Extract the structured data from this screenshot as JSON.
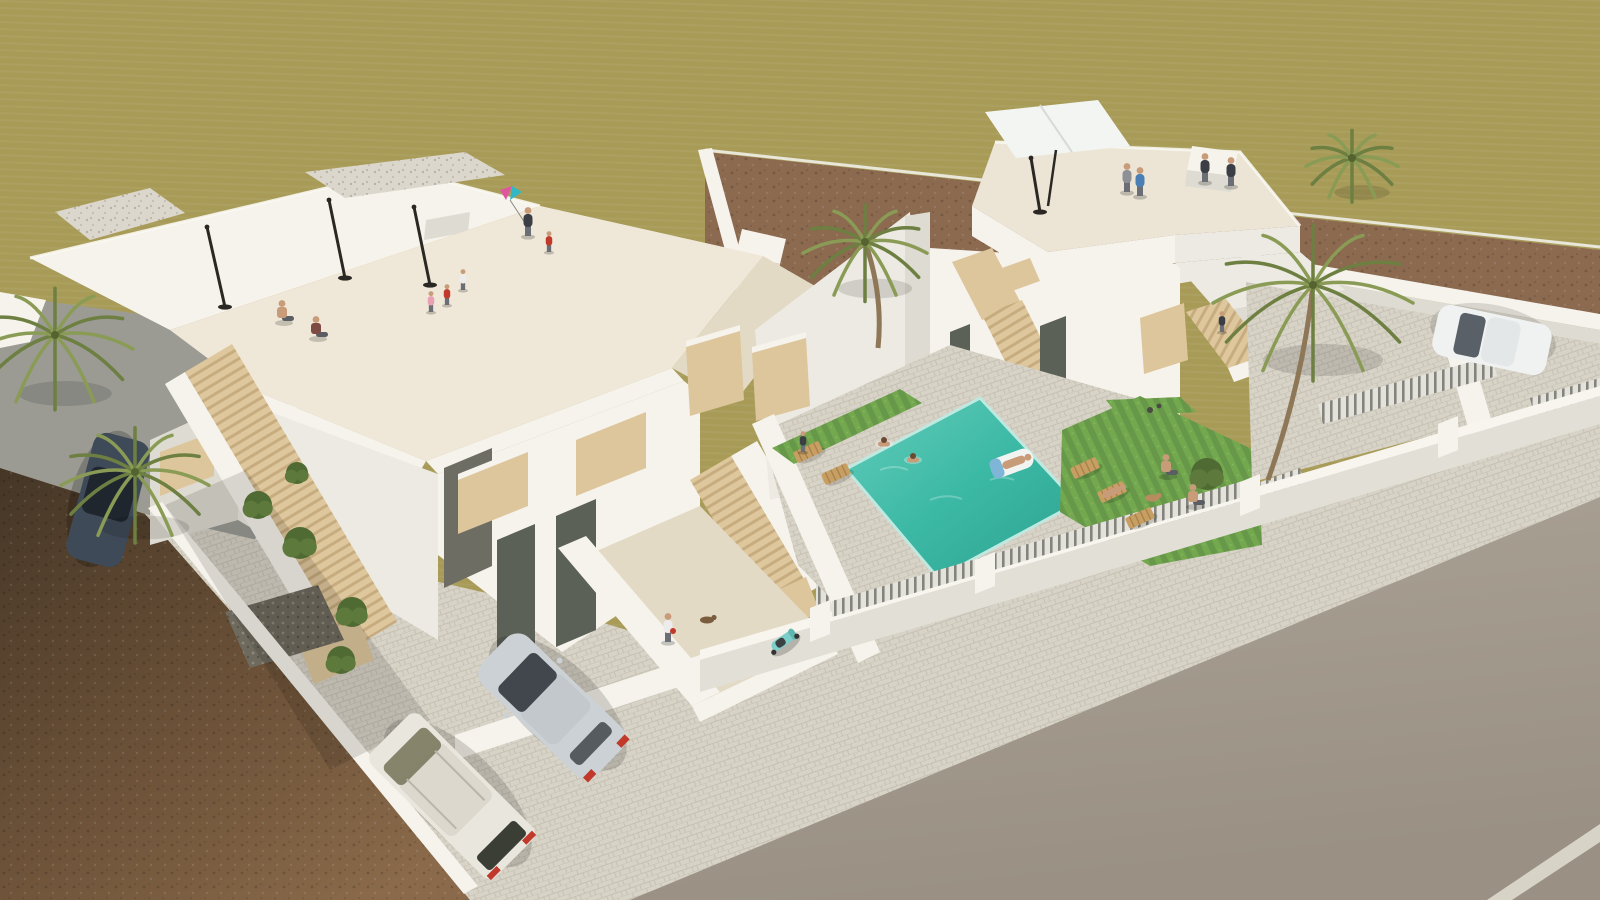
{
  "image": {
    "kind": "architectural-3d-render",
    "description": "Aerial 3D visualization of two modern white multi-storey villas with rooftop terraces, exterior beige staircases, a turquoise swimming pool with swimmers, lawns with sun loungers, palm trees, parked cars, perimeter walls with slatted fences, a cobbled sidewalk and a wide asphalt street; olive-khaki fields and brown dirt plots surround the site.",
    "visible_text": []
  },
  "palette": {
    "olive": "#a89b57",
    "olivelight": "#b7ab6c",
    "dirt": "#8b6a50",
    "dirtdark": "#6f5340",
    "soil": "#7d6146",
    "soildark": "#3f3022",
    "street": "#9b9b94",
    "road": "#a79f92",
    "roaddark": "#988f82",
    "sidewalk": "#d8d3c7",
    "cobbleline": "#c4bfb2",
    "wall": "#f6f3ec",
    "wallmid": "#eceae2",
    "wallshade": "#dedbd2",
    "walldark": "#c7c4ba",
    "cream": "#efe8d8",
    "creamshade": "#e3dac6",
    "wood": "#ddc69c",
    "wooddark": "#c2a87a",
    "glass": "#5c6158",
    "glasslight": "#7c8177",
    "pool": "#3cb9a5",
    "pooldeep": "#2da391",
    "poollight": "#63cdbb",
    "grass": "#73a84f",
    "grassdark": "#628f41",
    "palm": "#6d7f41",
    "palmlight": "#8a9b55",
    "trunk": "#8d7757",
    "carsilver": "#ccd1d5",
    "carglass": "#42474e",
    "van": "#e9e6dd",
    "cardark": "#3f4a58",
    "carwhite": "#f0f2f2",
    "scooter": "#7ccfc9",
    "red": "#c0392b",
    "skin": "#c89b79",
    "black": "#2b2824",
    "white": "#faf8f2"
  },
  "clothing_colors": {
    "skin": "#c89b79",
    "red": "#c0392b",
    "white": "#ececec",
    "blue": "#4a7fb5",
    "gray": "#8d9197",
    "dark": "#3b3f45",
    "maroon": "#7e4a44",
    "pink": "#e8a0b4"
  },
  "scene": {
    "people": [
      {
        "name": "sitting-shirtless-man",
        "x": 282,
        "y": 322,
        "pose": "sit",
        "shirt": "skin"
      },
      {
        "name": "sitting-woman",
        "x": 316,
        "y": 338,
        "pose": "sit",
        "shirt": "maroon"
      },
      {
        "name": "boy-red-shirt",
        "x": 447,
        "y": 305,
        "pose": "stand",
        "shirt": "red",
        "small": true
      },
      {
        "name": "boy-white-shirt",
        "x": 463,
        "y": 290,
        "pose": "stand",
        "shirt": "white",
        "small": true
      },
      {
        "name": "toddler-pink",
        "x": 431,
        "y": 312,
        "pose": "stand",
        "shirt": "pink",
        "small": true
      },
      {
        "name": "woman-with-kite",
        "x": 528,
        "y": 236,
        "pose": "stand",
        "shirt": "dark"
      },
      {
        "name": "kid-near-kite",
        "x": 549,
        "y": 252,
        "pose": "stand",
        "shirt": "red",
        "small": true
      },
      {
        "name": "man-blue-shirt-roof",
        "x": 1140,
        "y": 196,
        "pose": "stand",
        "shirt": "blue"
      },
      {
        "name": "woman-gray-roof",
        "x": 1127,
        "y": 192,
        "pose": "stand",
        "shirt": "gray"
      },
      {
        "name": "dark-figure-roof-1",
        "x": 1205,
        "y": 182,
        "pose": "stand",
        "shirt": "dark"
      },
      {
        "name": "dark-figure-roof-2",
        "x": 1231,
        "y": 186,
        "pose": "stand",
        "shirt": "dark"
      },
      {
        "name": "figure-on-stair",
        "x": 1222,
        "y": 332,
        "pose": "stand",
        "shirt": "dark",
        "small": true
      },
      {
        "name": "courtyard-man-red-bag",
        "x": 668,
        "y": 642,
        "pose": "stand",
        "shirt": "white",
        "bag": true
      },
      {
        "name": "balcony-figure",
        "x": 803,
        "y": 452,
        "pose": "stand",
        "shirt": "dark",
        "small": true
      },
      {
        "name": "swimmer-1",
        "x": 884,
        "y": 444,
        "pose": "swim"
      },
      {
        "name": "swimmer-2",
        "x": 913,
        "y": 460,
        "pose": "swim"
      },
      {
        "name": "lawn-sitter-1",
        "x": 1166,
        "y": 476,
        "pose": "sit",
        "shirt": "skin"
      },
      {
        "name": "lawn-sitter-2",
        "x": 1193,
        "y": 506,
        "pose": "sit",
        "shirt": "skin"
      }
    ],
    "parasols_closed": [
      {
        "x": 225,
        "y": 307,
        "tx": 207,
        "ty": 227
      },
      {
        "x": 345,
        "y": 278,
        "tx": 329,
        "ty": 200
      },
      {
        "x": 430,
        "y": 285,
        "tx": 414,
        "ty": 207
      },
      {
        "x": 1040,
        "y": 212,
        "tx": 1031,
        "ty": 158
      }
    ],
    "loungers": [
      {
        "x": 808,
        "y": 452
      },
      {
        "x": 836,
        "y": 474
      },
      {
        "x": 1085,
        "y": 468
      },
      {
        "x": 1112,
        "y": 492,
        "person": true
      },
      {
        "x": 1140,
        "y": 518
      }
    ],
    "palms": [
      {
        "x": 55,
        "y": 335,
        "r": 78
      },
      {
        "x": 135,
        "y": 472,
        "r": 74
      },
      {
        "x": 865,
        "y": 242,
        "r": 62,
        "trunk": [
          878,
          348
        ]
      },
      {
        "x": 1313,
        "y": 285,
        "r": 100,
        "trunk": [
          1268,
          480
        ]
      },
      {
        "x": 1352,
        "y": 158,
        "r": 46
      }
    ],
    "shrubs": [
      {
        "x": 258,
        "y": 505,
        "r": 14
      },
      {
        "x": 300,
        "y": 543,
        "r": 16
      },
      {
        "x": 352,
        "y": 612,
        "r": 15
      },
      {
        "x": 297,
        "y": 473,
        "r": 11
      },
      {
        "x": 341,
        "y": 660,
        "r": 14
      },
      {
        "x": 1207,
        "y": 474,
        "r": 16
      }
    ],
    "dogs": [
      {
        "x": 707,
        "y": 620,
        "c": "#7a5c3e"
      },
      {
        "x": 1152,
        "y": 498,
        "c": "#b98c5f"
      }
    ],
    "vehicles": [
      {
        "name": "silver-hatchback",
        "color": "carsilver"
      },
      {
        "name": "white-van",
        "color": "van"
      },
      {
        "name": "dark-blue-car",
        "color": "cardark"
      },
      {
        "name": "white-car",
        "color": "carwhite"
      },
      {
        "name": "teal-scooter",
        "color": "scooter"
      }
    ],
    "pool": {
      "swimmers": 2,
      "float_occupied": true,
      "color": "pool"
    }
  }
}
